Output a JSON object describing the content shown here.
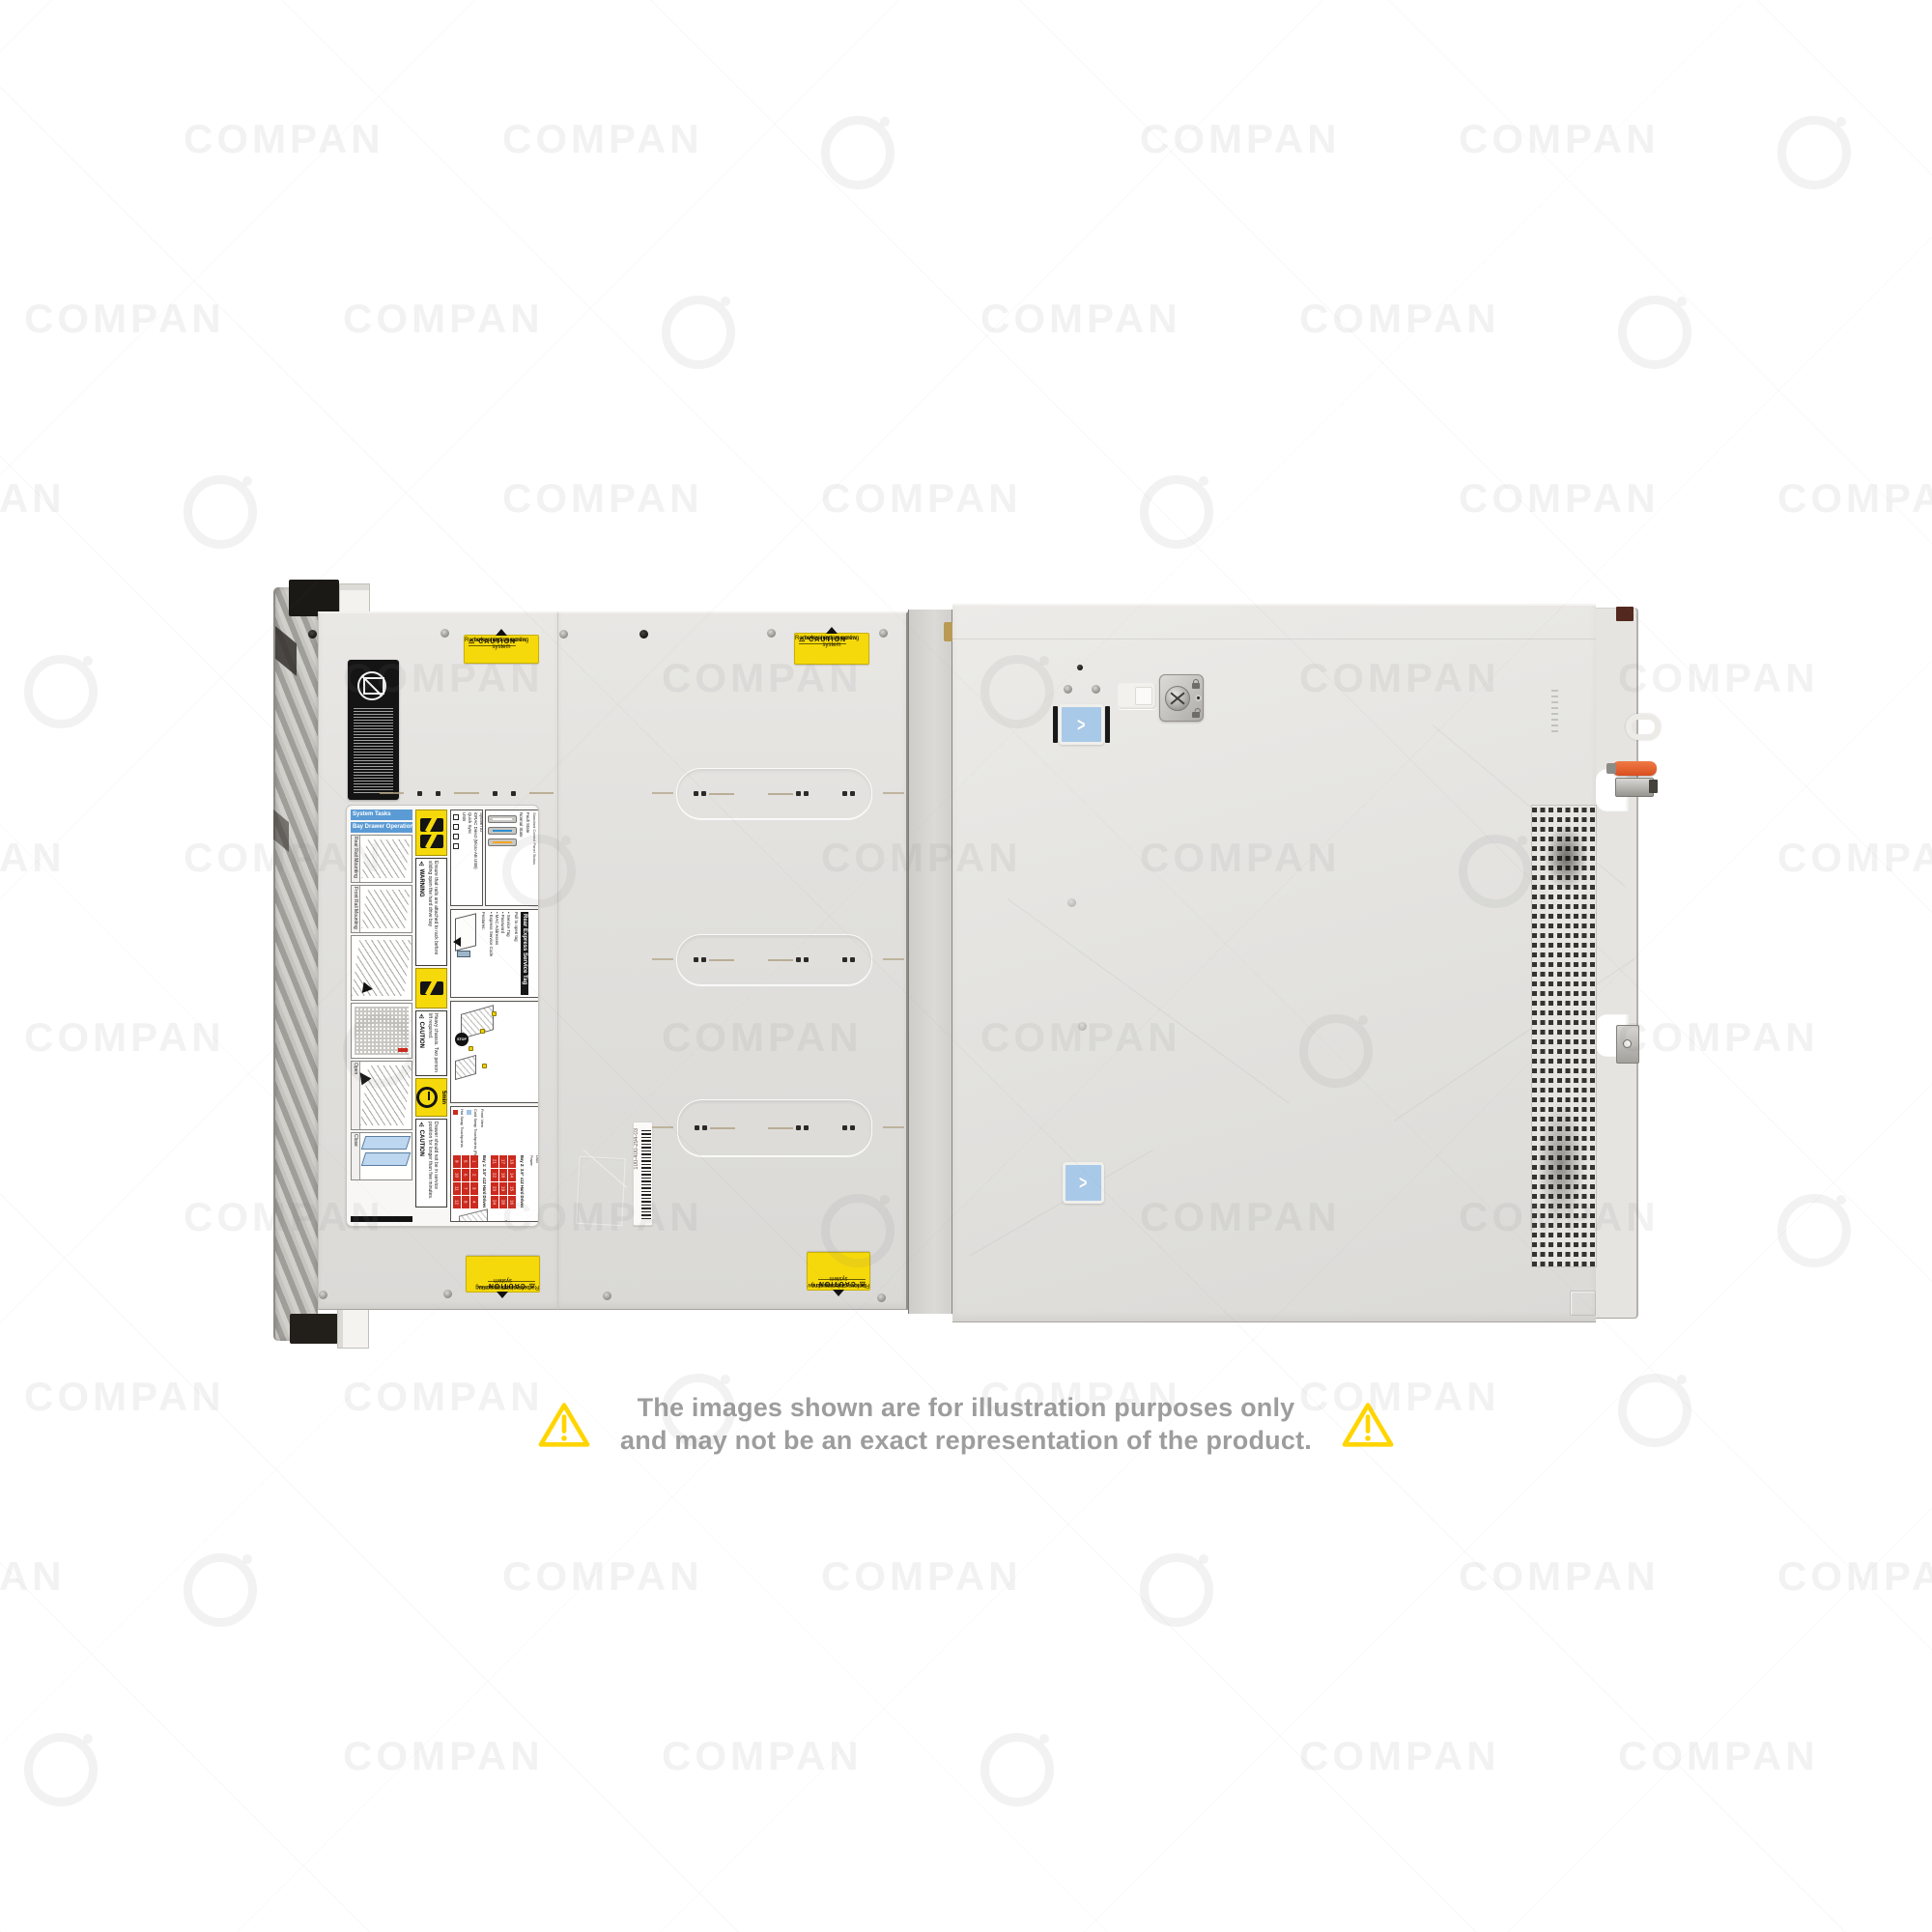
{
  "page": {
    "background": "#ffffff"
  },
  "disclaimer": {
    "line1": "The images shown are for illustration purposes only",
    "line2": "and may not be an exact representation of the product.",
    "text_color": "#9d9d9d",
    "triangle_color": "#ffd500"
  },
  "watermark": {
    "text": "COMPAN"
  },
  "server": {
    "caution_label": {
      "title": "⚠ CAUTION",
      "line1": "Remove shipping screw",
      "line2": "before rack mounting system"
    },
    "barcode_label": {
      "text": "100-400-294-03"
    },
    "latch": {
      "chevron": ">"
    },
    "service_label": {
      "system_tasks": "System Tasks",
      "bay_drawer": "Bay Drawer Operation",
      "rail_captions": [
        "Rear Rail Mounting",
        "Front Rail Mounting",
        "Open",
        "Close"
      ],
      "warning_title": "⚠ WARNING",
      "warning_text": "Ensure that rails are attached to rack before sliding open the hard drive bay",
      "caution_heavy_title": "⚠ CAUTION",
      "caution_heavy_text": "Heavy chassis. Two person lift required.",
      "five_min": "5min",
      "caution_drawer_title": "⚠ CAUTION",
      "caution_drawer_text": "Drawer should not be in service position for longer than five minutes.",
      "icon_legend_title": "Icon Legend",
      "icon_legend_items": [
        "System ID",
        "iDRAC Direct (Micro-AB USB)",
        "Quick Sync",
        "USB"
      ],
      "led_title": "LED Button Behavior",
      "led_subtitle": "Standard Control Panel Status",
      "led_states": [
        "Normal State",
        "Fault State"
      ],
      "rest_title": "Rear Express Service Tag",
      "rest_features_heading": "Features:",
      "rest_features": [
        "Service Tag",
        "Password",
        "MAC Addresses",
        "Express Service Code"
      ],
      "rest_note": "Pull to open tag",
      "ssr_title": "Shipping Screw Removal",
      "ssr_stop": "STOP",
      "ssr_text": "Remove shipping screws before rack mounting system.",
      "config_title": "Configuration and Layout",
      "config_front_view": "Front View",
      "config_hot": "Hot Swap Touchpoints",
      "config_cold": "Cold Swap Touchpoints (Rear)",
      "config_bay1": "Bay 1: 3.5\" x12 Hard Drives",
      "config_bay2": "Bay 2: 3.5\" x12 Hard Drives",
      "config_side_labels": [
        "System ID/Status Light Bar",
        "Hard Drive Activity",
        "iDRAC Direct (Micro-AB USB)",
        "USB",
        "Power"
      ],
      "bay1_cells_rotated": [
        9,
        5,
        1,
        10,
        6,
        2,
        11,
        7,
        3,
        12,
        8,
        4
      ],
      "bay2_cells_rotated": [
        21,
        17,
        13,
        22,
        18,
        14,
        23,
        19,
        15,
        24,
        20,
        16
      ]
    },
    "colors": {
      "caution_yellow": "#f6d90a",
      "latch_blue": "#a9c9e9",
      "lever_orange": "#e2572b",
      "led_normal_blue": "#2f8fd4",
      "led_fault_orange": "#f5a623",
      "bay_table_red": "#cc2a1e"
    }
  }
}
